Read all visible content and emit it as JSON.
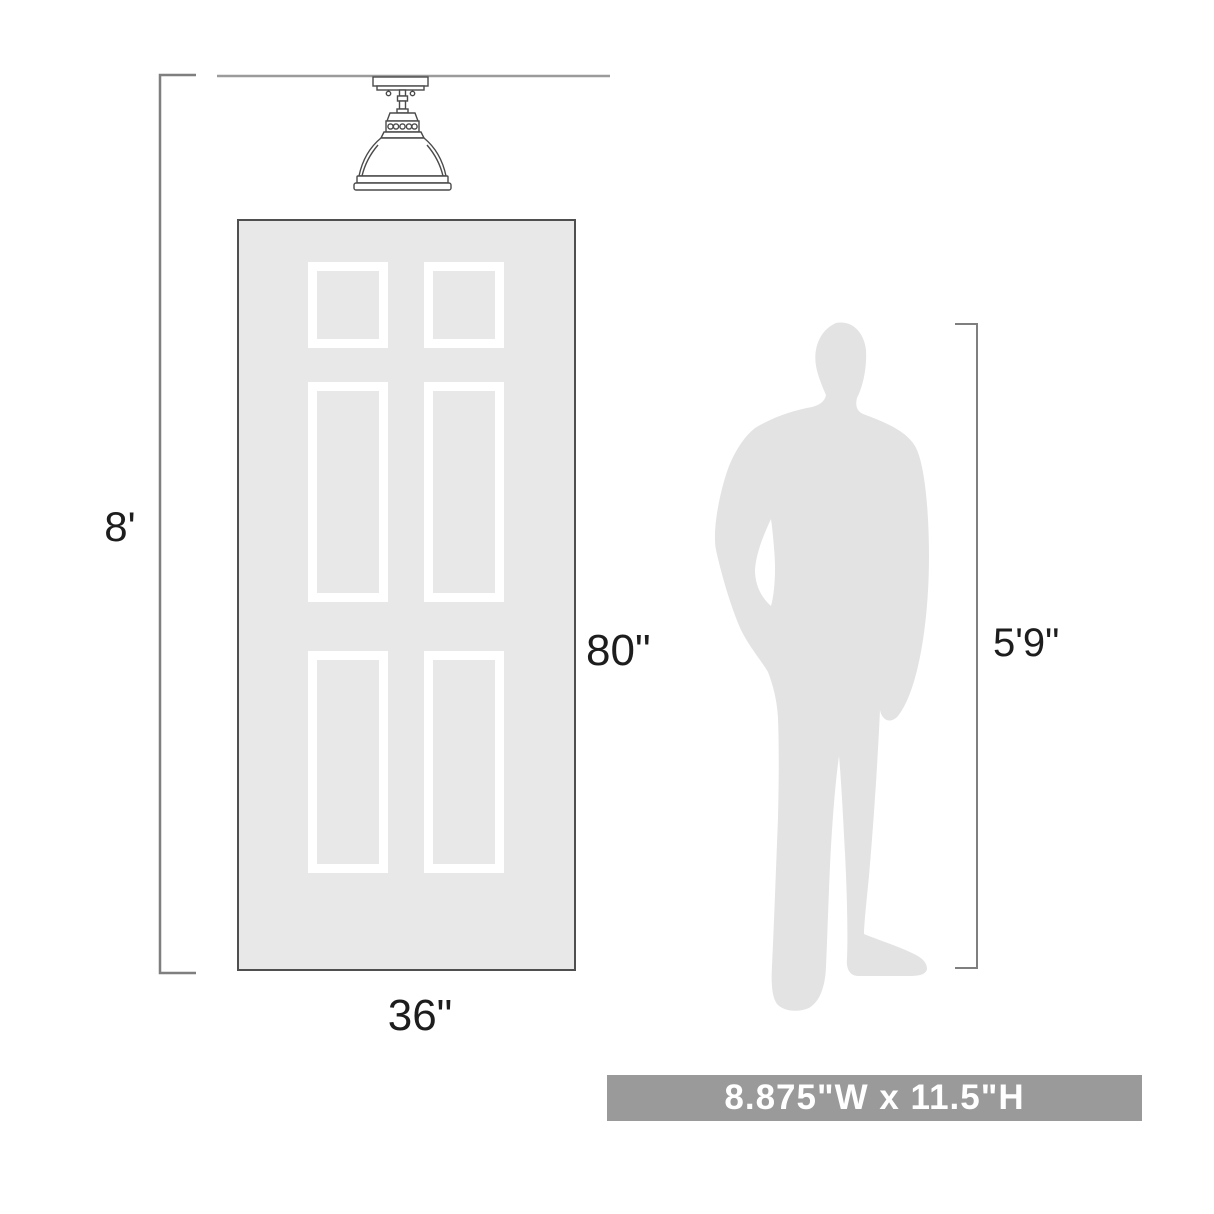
{
  "diagram": {
    "ceiling_height_label": "8'",
    "door_height_label": "80\"",
    "door_width_label": "36\"",
    "person_height_label": "5'9\""
  },
  "banner": {
    "text": "8.875\"W x 11.5\"H"
  },
  "icons": {
    "fixture": "semi-flush-ceiling-light-drawing",
    "door": "six-panel-door-drawing",
    "person": "standing-man-silhouette"
  },
  "colors": {
    "background": "#ffffff",
    "door_fill": "#e8e8e8",
    "door_border": "#4f4f4f",
    "panel_frame": "#ffffff",
    "silhouette_fill": "#e3e3e3",
    "dimension_line": "#7f7f7f",
    "ceiling_line": "#9b9b9b",
    "fixture_line": "#4a4a4a",
    "label_text": "#1d1d1d",
    "banner_bg": "#9a9a9a",
    "banner_text": "#ffffff"
  }
}
